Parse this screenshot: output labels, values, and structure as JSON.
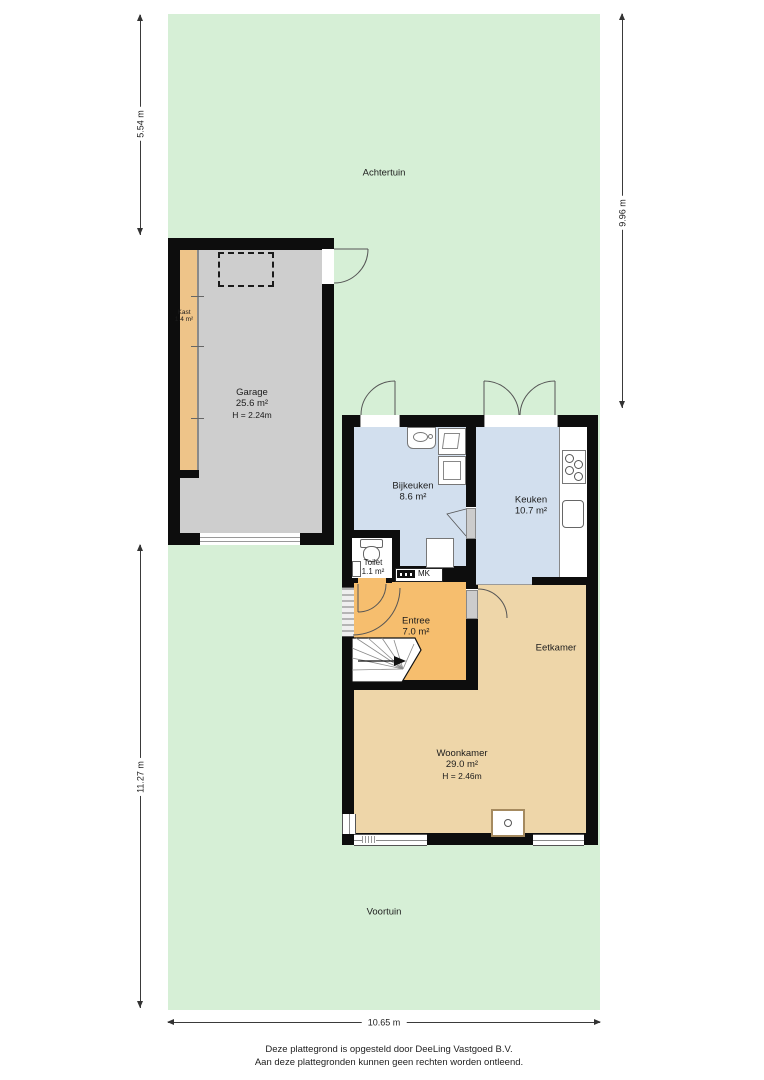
{
  "garden": {
    "back": "Achtertuin",
    "front": "Voortuin"
  },
  "dimensions": {
    "back_depth": "5.54 m",
    "right_height": "9.96 m",
    "front_depth": "11.27 m",
    "width": "10.65 m"
  },
  "rooms": {
    "garage": {
      "name": "Garage",
      "area": "25.6 m²",
      "ceiling": "H = 2.24m"
    },
    "kast": {
      "name": "Kast",
      "area": "1.4 m²"
    },
    "bijkeuken": {
      "name": "Bijkeuken",
      "area": "8.6 m²"
    },
    "keuken": {
      "name": "Keuken",
      "area": "10.7 m²"
    },
    "toilet": {
      "name": "Toilet",
      "area": "1.1 m²"
    },
    "meterkast": {
      "name": "MK"
    },
    "entree": {
      "name": "Entree",
      "area": "7.0 m²"
    },
    "eetkamer": {
      "name": "Eetkamer"
    },
    "woonkamer": {
      "name": "Woonkamer",
      "area": "29.0 m²",
      "ceiling": "H = 2.46m"
    }
  },
  "footer": {
    "line1": "Deze plattegrond is opgesteld door DeeLing Vastgoed B.V.",
    "line2": "Aan deze plattegronden kunnen geen rechten worden ontleend."
  },
  "colors": {
    "garden": "#d6efd6",
    "garage_floor": "#cecece",
    "kast_floor": "#eec489",
    "wet_room_floor": "#d2dfee",
    "entree_floor": "#f6be6e",
    "living_floor": "#eed6a9",
    "wall": "#0d0d0d"
  }
}
